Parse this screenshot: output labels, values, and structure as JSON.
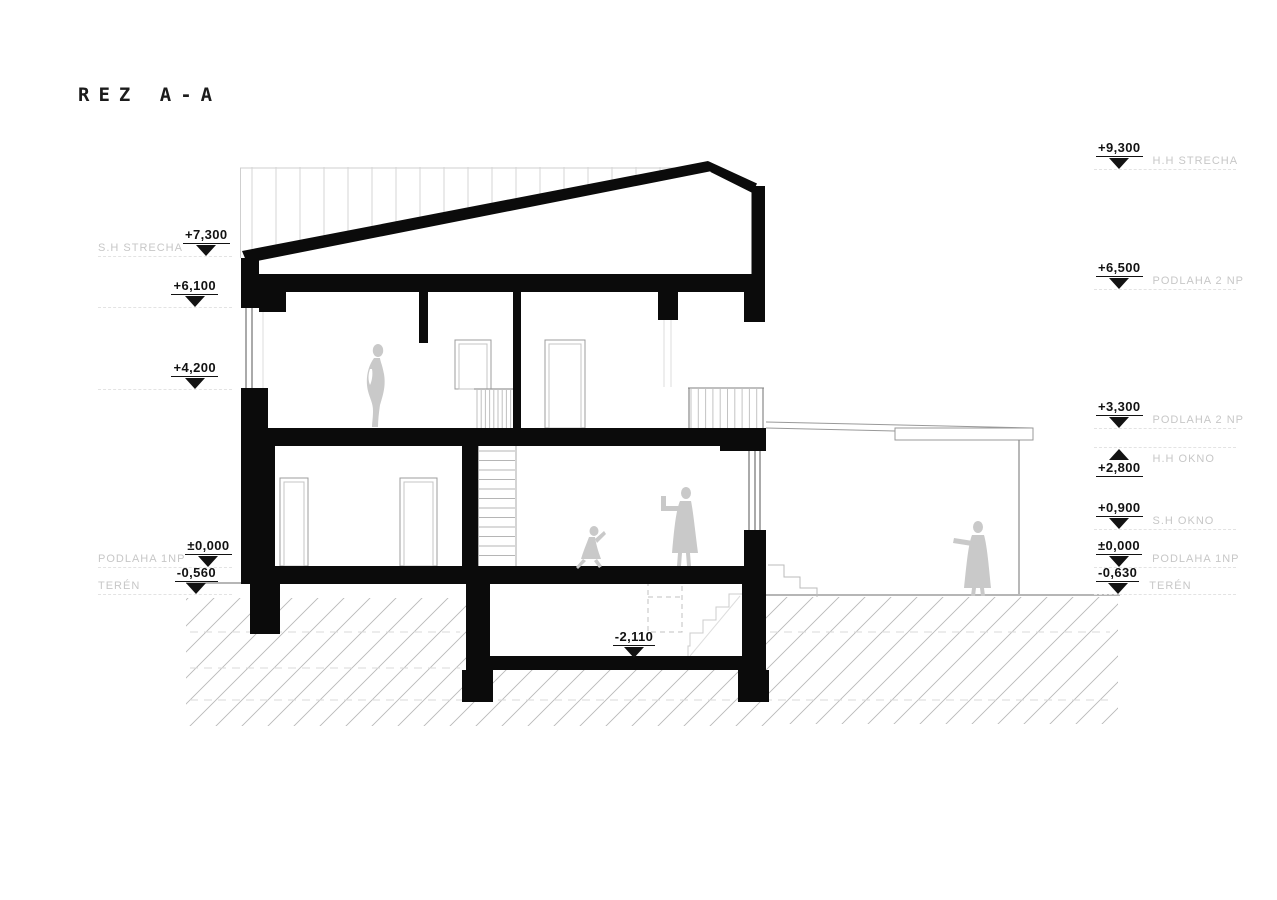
{
  "title": "REZ A-A",
  "colors": {
    "ink": "#111111",
    "label_gray": "#c7c7c7",
    "figure_gray": "#c9c9c9",
    "hatch_gray": "#b8b8b8"
  },
  "levels": {
    "left": [
      {
        "value": "+7,300",
        "label": "S.H STRECHA"
      },
      {
        "value": "+6,100",
        "label": ""
      },
      {
        "value": "+4,200",
        "label": ""
      },
      {
        "value": "±0,000",
        "label": "PODLAHA 1NP"
      },
      {
        "value": "-0,560",
        "label": "TERÉN"
      }
    ],
    "right": [
      {
        "value": "+9,300",
        "label": "H.H STRECHA"
      },
      {
        "value": "+6,500",
        "label": "PODLAHA 2 NP"
      },
      {
        "value": "+3,300",
        "label": "PODLAHA 2 NP"
      },
      {
        "value": "+2,800",
        "label": "H.H OKNO"
      },
      {
        "value": "+0,900",
        "label": "S.H OKNO"
      },
      {
        "value": "±0,000",
        "label": "PODLAHA 1NP"
      },
      {
        "value": "-0,630",
        "label": "TERÉN"
      }
    ],
    "basement": {
      "value": "-2,110"
    }
  }
}
